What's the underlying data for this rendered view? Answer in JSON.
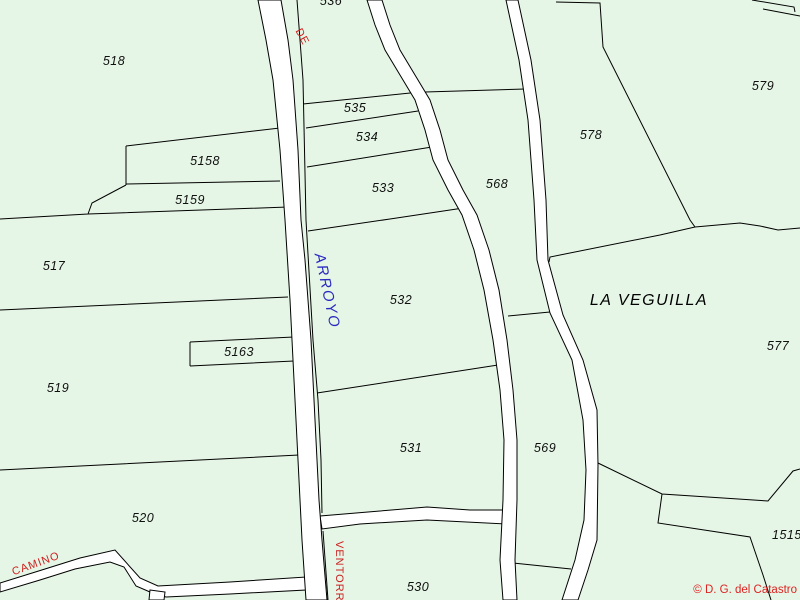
{
  "map": {
    "type": "cadastral-parcel-map",
    "colors": {
      "background": "#e6f6e6",
      "road_fill": "#ffffff",
      "boundary_line": "#000000",
      "parcel_label": "#101010",
      "road_label_red": "#cc2222",
      "water_label_blue": "#2a2ac0",
      "copyright_red": "#dd2222"
    },
    "parcel_labels": [
      {
        "id": "518",
        "text": "518"
      },
      {
        "id": "536",
        "text": "536"
      },
      {
        "id": "535",
        "text": "535"
      },
      {
        "id": "534",
        "text": "534"
      },
      {
        "id": "533",
        "text": "533"
      },
      {
        "id": "568",
        "text": "568"
      },
      {
        "id": "578",
        "text": "578"
      },
      {
        "id": "579",
        "text": "579"
      },
      {
        "id": "5158",
        "text": "5158"
      },
      {
        "id": "5159",
        "text": "5159"
      },
      {
        "id": "517",
        "text": "517"
      },
      {
        "id": "532",
        "text": "532"
      },
      {
        "id": "5163",
        "text": "5163"
      },
      {
        "id": "519",
        "text": "519"
      },
      {
        "id": "531",
        "text": "531"
      },
      {
        "id": "569",
        "text": "569"
      },
      {
        "id": "577",
        "text": "577"
      },
      {
        "id": "520",
        "text": "520"
      },
      {
        "id": "530",
        "text": "530"
      },
      {
        "id": "1515",
        "text": "1515-"
      }
    ],
    "path_labels": [
      {
        "id": "de",
        "text": "DE",
        "color": "#cc2222"
      },
      {
        "id": "arroyo",
        "text": "ARROYO",
        "color": "#2a2ac0"
      },
      {
        "id": "camino",
        "text": "CAMINO",
        "color": "#cc2222"
      },
      {
        "id": "ventorrillo",
        "text": "VENTORRIL",
        "color": "#cc2222"
      }
    ],
    "place_name": "LA VEGUILLA",
    "copyright": "© D. G. del Catastro"
  }
}
